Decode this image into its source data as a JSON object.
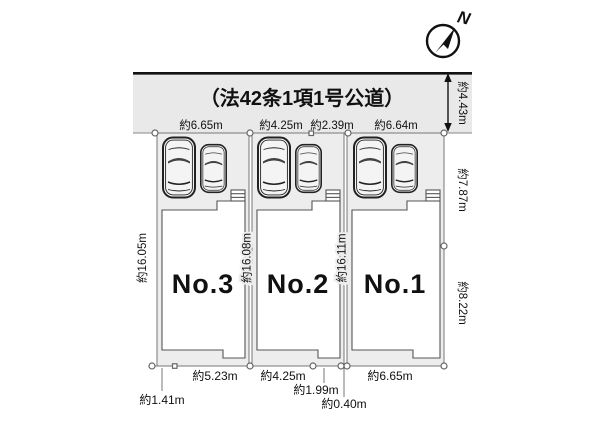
{
  "road": {
    "label": "（法42条1項1号公道）",
    "width_dim": "約4.43m"
  },
  "compass": {
    "north": "N"
  },
  "dimensions": {
    "top": [
      "約6.65m",
      "約4.25m",
      "約2.39m",
      "約6.64m"
    ],
    "left": "約16.05m",
    "between_lot3_lot2": "約16.08m",
    "between_lot2_lot1": "約16.11m",
    "right_upper": "約7.87m",
    "right_lower": "約8.22m",
    "bottom": [
      "約5.23m",
      "約4.25m",
      "約1.99m",
      "約0.40m",
      "約6.65m",
      "約1.41m"
    ]
  },
  "lots": [
    {
      "name": "No.3"
    },
    {
      "name": "No.2"
    },
    {
      "name": "No.1"
    }
  ],
  "colors": {
    "road_fill": "#e9e9e9",
    "parcel_fill": "#ededed",
    "line": "#555555",
    "ink": "#111111"
  }
}
